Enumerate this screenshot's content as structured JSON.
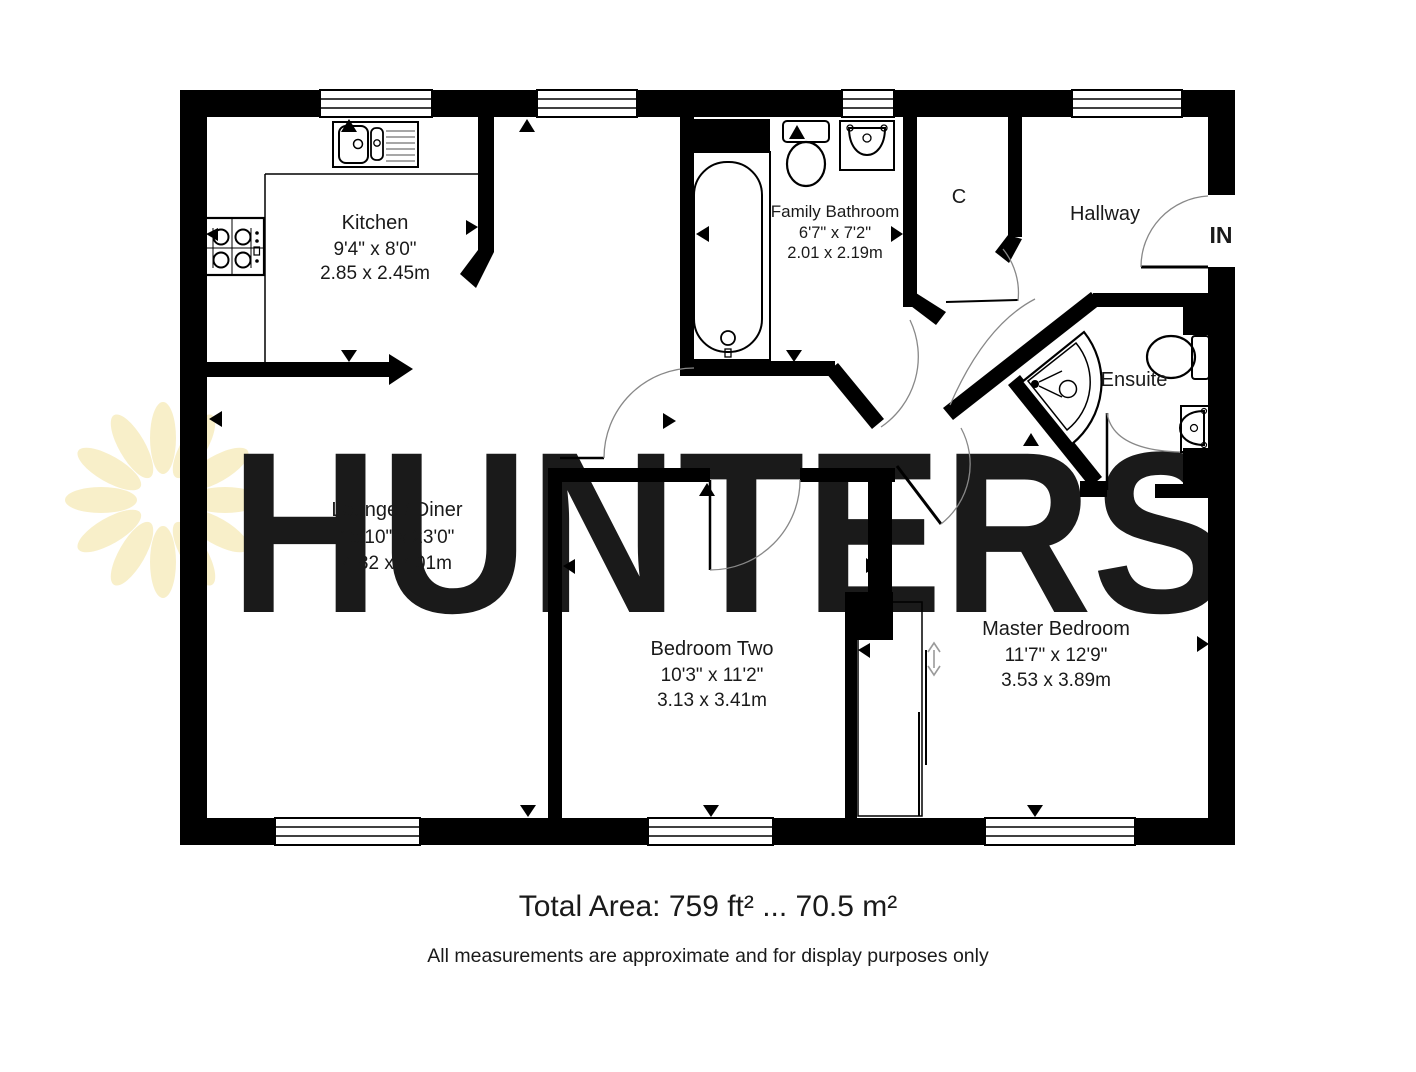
{
  "watermark": {
    "text": "HUNTERS"
  },
  "rooms": {
    "kitchen": {
      "name": "Kitchen",
      "size_imperial": "9'4\" x 8'0\"",
      "size_metric": "2.85 x 2.45m"
    },
    "family_bathroom": {
      "name": "Family Bathroom",
      "size_imperial": "6'7\" x 7'2\"",
      "size_metric": "2.01 x 2.19m"
    },
    "lounge_diner": {
      "name": "Lounge / Diner",
      "size_imperial": "15'10\" x 23'0\"",
      "size_metric": "4.82 x 7.01m"
    },
    "bedroom_two": {
      "name": "Bedroom Two",
      "size_imperial": "10'3\" x 11'2\"",
      "size_metric": "3.13 x 3.41m"
    },
    "master_bedroom": {
      "name": "Master Bedroom",
      "size_imperial": "11'7\" x 12'9\"",
      "size_metric": "3.53 x 3.89m"
    },
    "cupboard": {
      "name": "C"
    },
    "hallway": {
      "name": "Hallway"
    },
    "ensuite": {
      "name": "Ensuite"
    },
    "entrance": {
      "name": "IN"
    }
  },
  "footer": {
    "total_area": "Total Area: 759 ft² ... 70.5 m²",
    "disclaimer": "All measurements are approximate and for display purposes only"
  },
  "colors": {
    "wall": "#000000",
    "background": "#ffffff",
    "watermark": "#f9f1cf",
    "door_arc": "#888888"
  },
  "icons": {
    "kitchen_sink": "kitchen-sink-icon",
    "hob": "hob-icon",
    "bath": "bathtub-icon",
    "toilet": "toilet-icon",
    "basin": "basin-icon",
    "shower": "corner-shower-icon",
    "wardrobe": "sliding-wardrobe-icon",
    "entrance_door": "entrance-door-icon",
    "window": "window-icon",
    "measurement_marker": "measurement-arrow-icon",
    "logo": "hunters-sunburst-icon"
  }
}
